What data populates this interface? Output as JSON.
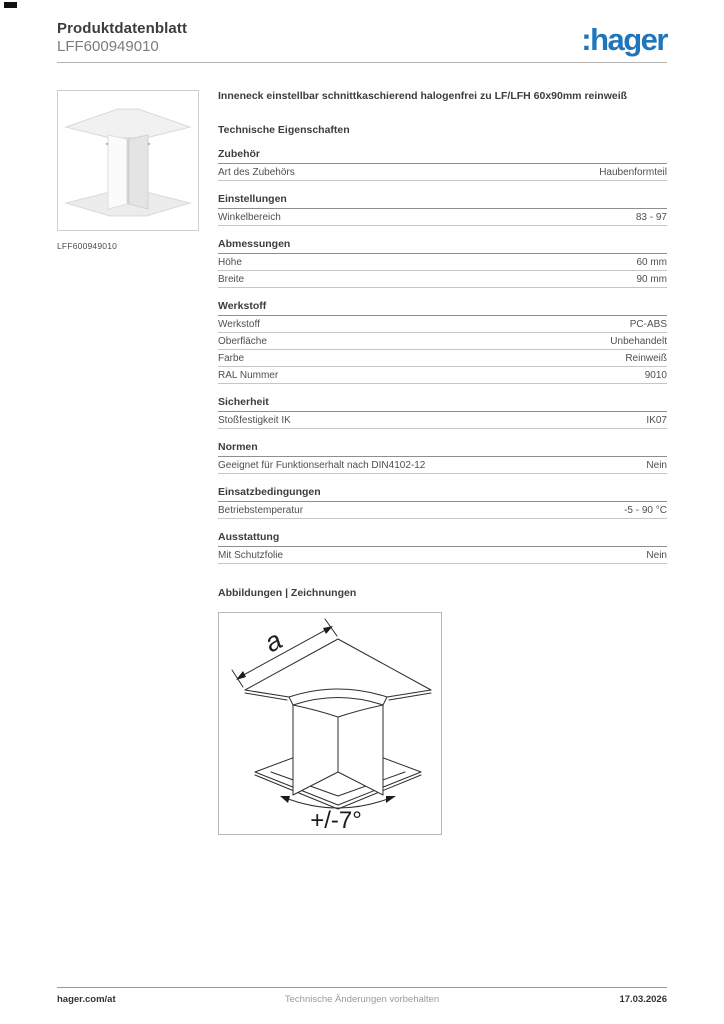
{
  "header": {
    "doc_type": "Produktdatenblatt",
    "reference": "LFF600949010",
    "logo_text": ":hager",
    "brand_color": "#1f76bc"
  },
  "product": {
    "thumbnail_caption": "LFF600949010",
    "title": "Inneneck einstellbar schnittkaschierend halogenfrei zu LF/LFH 60x90mm reinweiß"
  },
  "tech": {
    "heading": "Technische Eigenschaften",
    "sections": [
      {
        "heading": "Zubehör",
        "rows": [
          {
            "label": "Art des Zubehörs",
            "value": "Haubenformteil"
          }
        ]
      },
      {
        "heading": "Einstellungen",
        "rows": [
          {
            "label": "Winkelbereich",
            "value": "83 - 97"
          }
        ]
      },
      {
        "heading": "Abmessungen",
        "rows": [
          {
            "label": "Höhe",
            "value": "60 mm"
          },
          {
            "label": "Breite",
            "value": "90 mm"
          }
        ]
      },
      {
        "heading": "Werkstoff",
        "rows": [
          {
            "label": "Werkstoff",
            "value": "PC-ABS"
          },
          {
            "label": "Oberfläche",
            "value": "Unbehandelt"
          },
          {
            "label": "Farbe",
            "value": "Reinweiß"
          },
          {
            "label": "RAL Nummer",
            "value": "9010"
          }
        ]
      },
      {
        "heading": "Sicherheit",
        "rows": [
          {
            "label": "Stoßfestigkeit IK",
            "value": "IK07"
          }
        ]
      },
      {
        "heading": "Normen",
        "rows": [
          {
            "label": "Geeignet für Funktionserhalt nach DIN4102-12",
            "value": "Nein"
          }
        ]
      },
      {
        "heading": "Einsatzbedingungen",
        "rows": [
          {
            "label": "Betriebstemperatur",
            "value": "-5 - 90 °C"
          }
        ]
      },
      {
        "heading": "Ausstattung",
        "rows": [
          {
            "label": "Mit Schutzfolie",
            "value": "Nein"
          }
        ]
      }
    ]
  },
  "drawings": {
    "heading": "Abbildungen | Zeichnungen",
    "dimension_label": "a",
    "angle_label": "+/-7°"
  },
  "footer": {
    "left": "hager.com/at",
    "center": "Technische Änderungen vorbehalten",
    "right": "17.03.2026"
  }
}
